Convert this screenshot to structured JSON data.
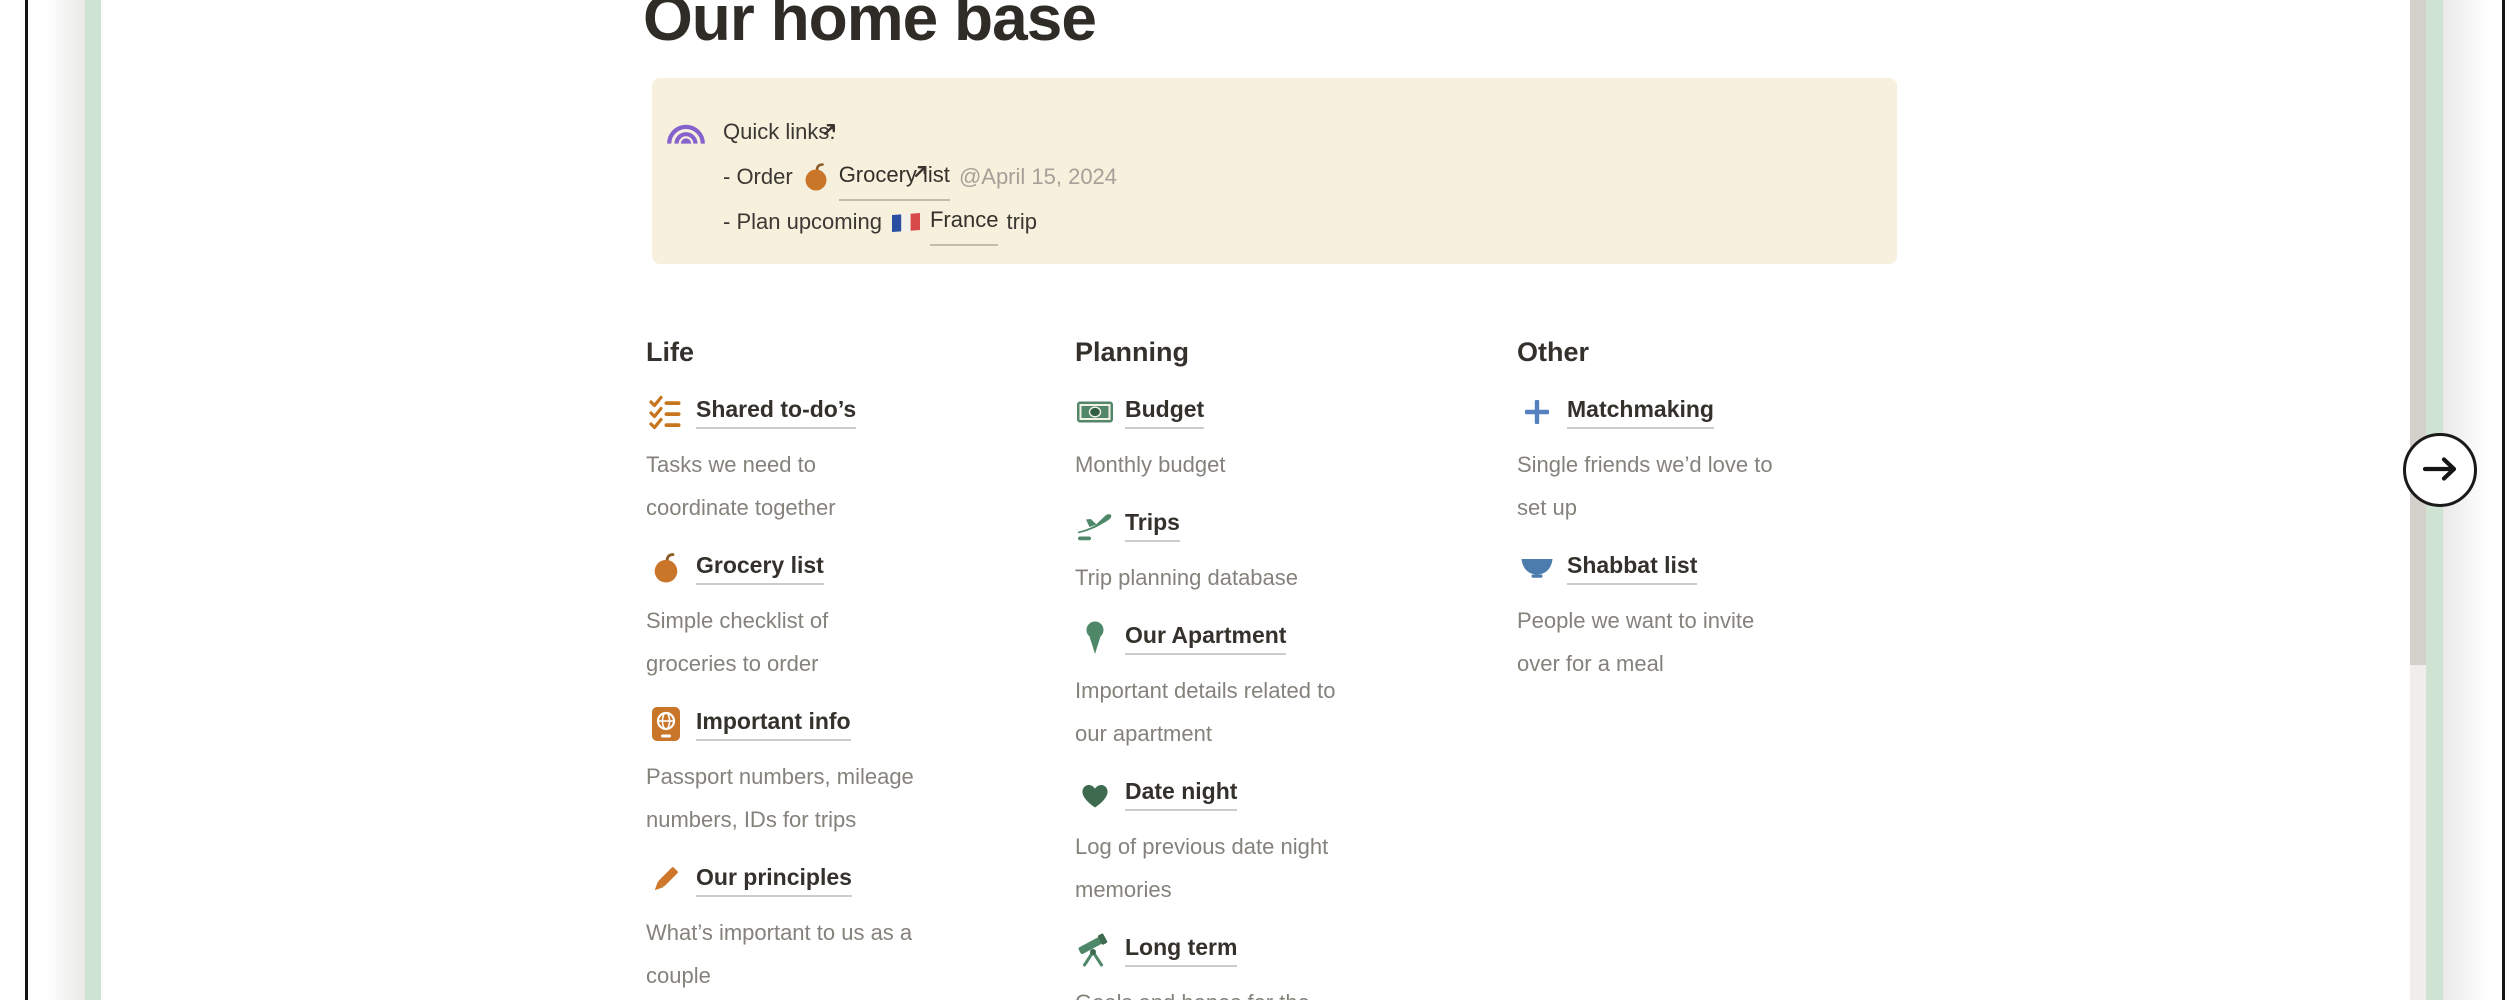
{
  "colors": {
    "callout_bg": "#f7f0dd",
    "green_strip": "#cfe3d2",
    "orange_icon": "#c9752a",
    "green_icon": "#4f8868",
    "dark_green_icon": "#3e6a50",
    "blue_icon": "#5581c1",
    "bowl_blue_icon": "#4b7cad",
    "purple_icon": "#8663cc",
    "text_dark": "#34312c",
    "text_gray": "#85827c",
    "date_gray": "#a5a198"
  },
  "page": {
    "title": "Our home base",
    "callout": {
      "icon": "rainbow-icon",
      "heading": "Quick links:",
      "links": [
        {
          "prefix": "- Order",
          "icon": "apple-icon",
          "link_text": "Grocery list",
          "date": "@April 15, 2024"
        },
        {
          "prefix": "- Plan upcoming",
          "icon": "france-flag-icon",
          "link_text": "France",
          "suffix": "trip"
        }
      ]
    },
    "columns": [
      {
        "heading": "Life",
        "items": [
          {
            "icon": "checklist-icon",
            "label": "Shared to-do’s",
            "description": "Tasks we need to\ncoordinate together"
          },
          {
            "icon": "apple-icon",
            "label": "Grocery list",
            "description": "Simple checklist of\ngroceries to order"
          },
          {
            "icon": "passport-icon",
            "label": "Important info",
            "description": "Passport numbers, mileage\nnumbers, IDs for trips"
          },
          {
            "icon": "pencil-icon",
            "label": "Our principles",
            "description": "What’s important to us as a\ncouple"
          }
        ]
      },
      {
        "heading": "Planning",
        "items": [
          {
            "icon": "banknote-icon",
            "label": "Budget",
            "description": "Monthly budget"
          },
          {
            "icon": "airplane-departure-icon",
            "label": "Trips",
            "description": "Trip planning database"
          },
          {
            "icon": "round-pushpin-icon",
            "label": "Our Apartment",
            "description": "Important details related to\nour apartment"
          },
          {
            "icon": "heart-icon",
            "label": "Date night",
            "description": "Log of previous date night\nmemories"
          },
          {
            "icon": "telescope-icon",
            "label": "Long term",
            "description": "Goals and hopes for the"
          }
        ]
      },
      {
        "heading": "Other",
        "items": [
          {
            "icon": "plus-icon",
            "label": "Matchmaking",
            "description": "Single friends we’d love to\nset up"
          },
          {
            "icon": "bowl-icon",
            "label": "Shabbat list",
            "description": "People we want to invite\nover for a meal"
          }
        ]
      }
    ]
  },
  "carousel": {
    "next_icon": "arrow-right-icon"
  }
}
